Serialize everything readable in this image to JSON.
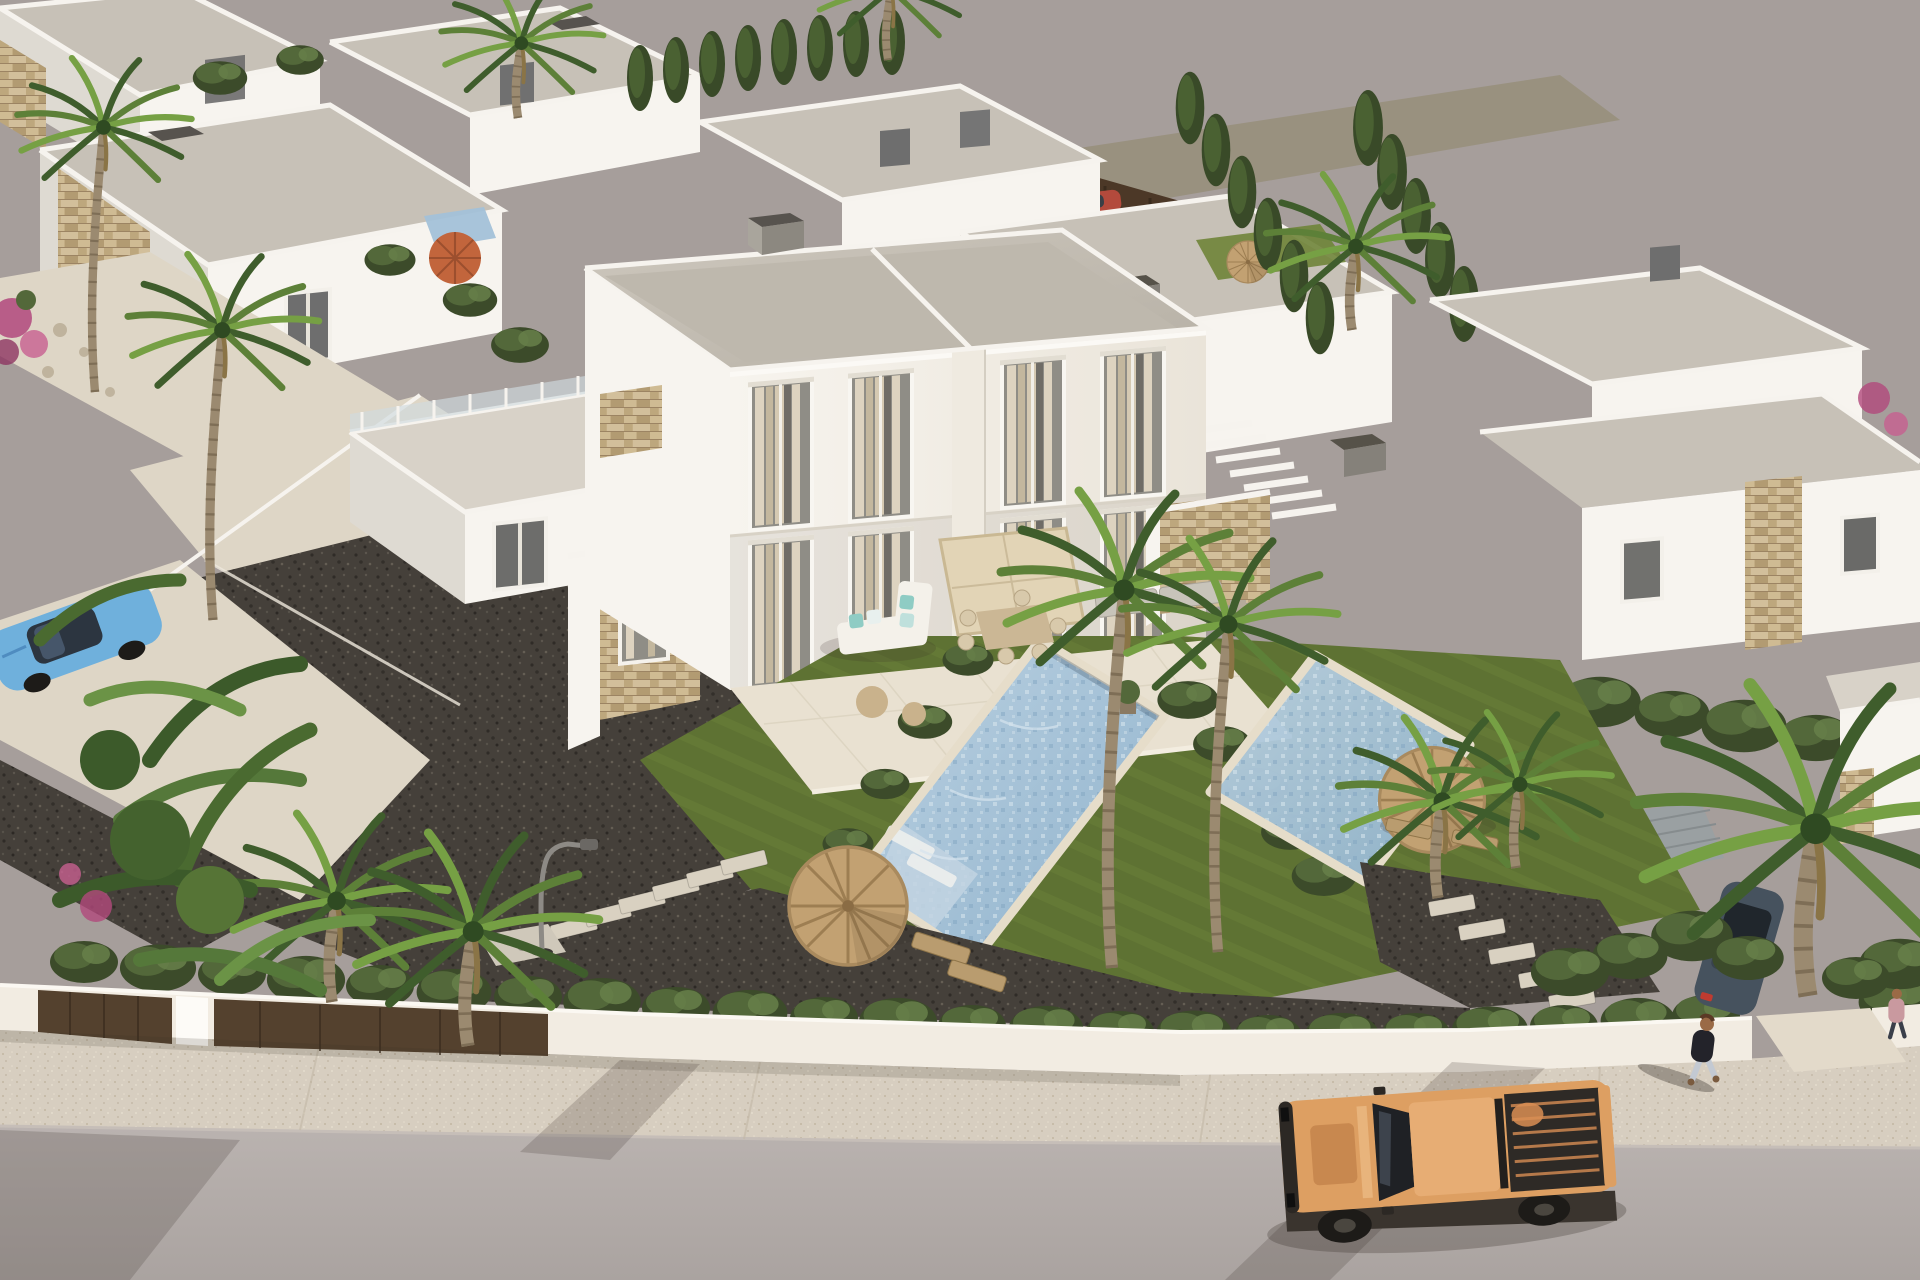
{
  "scene": {
    "description": "Aerial 3D architectural rendering of a modern Mediterranean residential development: white flat-roofed duplex villas with travertine stone accents, private mosaic pools, lawns, cypress hedges, gravel driveways and palm trees; a white perimeter wall with dark gates borders a sidewalk and street where an orange pickup truck is parked and a pedestrian walks; unfinished render background is flat warm gray",
    "camera": "high-angle aerial view",
    "lighting": "warm late-afternoon sun from the east, long soft shadows to the west",
    "visible_text": "none"
  },
  "palette": {
    "backdrop": "#a69e9b",
    "road": "#b4adaa",
    "sidewalk": "#d7cec0",
    "curb": "#c6beb8",
    "wall_white": "#f2ece2",
    "gate_brown": "#54412e",
    "wall_lit": "#f7f4ef",
    "wall_shade": "#dedad2",
    "wall_shadow": "#c6c2ba",
    "roof_gray": "#c7c1b7",
    "roof_light": "#d8d2c8",
    "stone": "#c3ad84",
    "stone_dark": "#a8906b",
    "window_glass": "#8f8d86",
    "window_dark": "#4e4e4e",
    "curtain_light": "#ddd3c0",
    "curtain_dark": "#c3b79e",
    "paving": "#ded6c6",
    "deck": "#e9e1d1",
    "coping": "#e6ddca",
    "lawn": "#5e7233",
    "lawn_light": "#6f8439",
    "gravel_dark": "#45403a",
    "hedge_dark": "#3c4b2a",
    "hedge_mid": "#53683a",
    "hedge_light": "#67804a",
    "pool_water": "#a3c1d8",
    "pool_shelf": "#c2d4e2",
    "thatch": "#c2a172",
    "thatch_dark": "#9d7e52",
    "parasol": "#e2d4b6",
    "umbrella_orange": "#c2653c",
    "truck_body": "#dd9f62",
    "truck_bed": "#2e2a26",
    "truck_bed_ribs": "#b5794a",
    "car_blue": "#6fb0dc",
    "car_dark": "#46525e",
    "car_red": "#b34a3c",
    "skin": "#9a6a46",
    "shirt_dark": "#23232a",
    "jeans": "#c3c9d2",
    "flower_pink": "#b2487c",
    "shadow": "rgba(55,47,40,0.30)"
  },
  "objects": {
    "main_villa": {
      "label": "two-storey duplex villa",
      "features": [
        "flat gray roof with white parapet",
        "dark chimney",
        "four floor-to-ceiling curtained windows",
        "stone-clad stair tower",
        "roof terrace with glass balustrade",
        "covered porch"
      ],
      "terrace": [
        "square beige parasol over dining table with chairs",
        "white L-shaped sofa with aqua cushions",
        "two sun loungers",
        "round poufs",
        "potted plant"
      ]
    },
    "pools": {
      "count": 2,
      "label": "private mosaic swimming pools",
      "details": [
        "beige coping",
        "sun shelf with two submerged white loungers"
      ]
    },
    "umbrellas": {
      "thatch": 3,
      "orange_parasol": 1,
      "beige_square_parasol": 1
    },
    "garden": [
      "lawns",
      "dark gravel driveways",
      "stepping-stone paths",
      "street lamp",
      "cypress hedge rows",
      "banana plants",
      "bougainvillea accents",
      "palm trees"
    ],
    "vehicles": [
      {
        "type": "pickup truck",
        "color_key": "truck_body",
        "location": "street, bottom right, open cargo bed"
      },
      {
        "type": "compact car",
        "color_key": "car_blue",
        "location": "left edge behind banana plants"
      },
      {
        "type": "car",
        "color_key": "car_dark",
        "location": "right driveway behind hedge"
      },
      {
        "type": "car",
        "color_key": "car_red",
        "location": "back lane, top center"
      }
    ],
    "people": [
      {
        "label": "pedestrian walking",
        "location": "street, right of truck"
      },
      {
        "label": "pedestrian",
        "location": "far right edge"
      }
    ],
    "perimeter": {
      "wall": "white rendered wall",
      "gates": "two dark brown entrance gates",
      "hedge": "continuous cypress hedge on top"
    },
    "background_villas": {
      "count": "≈10",
      "style": "white cubic villas with stone bands, roof terraces, external stairs, dark chimneys"
    }
  }
}
